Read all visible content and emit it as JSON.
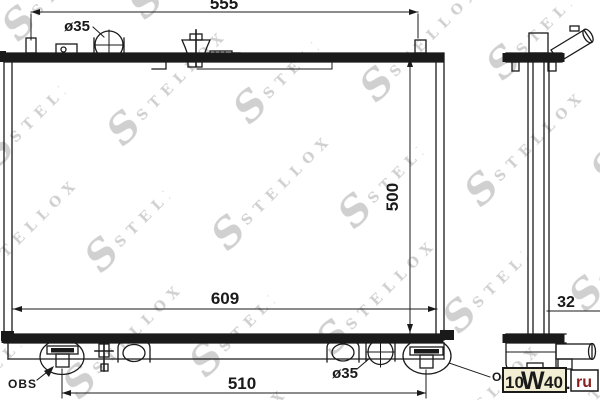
{
  "drawing": {
    "dim_top_width": "555",
    "dim_height": "500",
    "dim_bottom_width": "609",
    "dim_mount_span": "510",
    "dim_core_thickness": "32",
    "dia_top_port": "ø35",
    "dia_bottom_port": "ø35",
    "note_left": "OBS",
    "note_right": "OBS"
  },
  "watermark": {
    "initial": "S",
    "brand": "STELLOX"
  },
  "logo": {
    "p1": "10",
    "p2": "W",
    "p3": "40",
    "dot": ".",
    "tld": "ru",
    "box_bg": "#f1eed3",
    "tld_box_bg": "#ffffff",
    "text_color": "#1a1a1a",
    "tld_color": "#8b1e1e"
  },
  "colors": {
    "line": "#1a1a1a",
    "background": "#ffffff",
    "watermark": "#d0d0d0"
  }
}
